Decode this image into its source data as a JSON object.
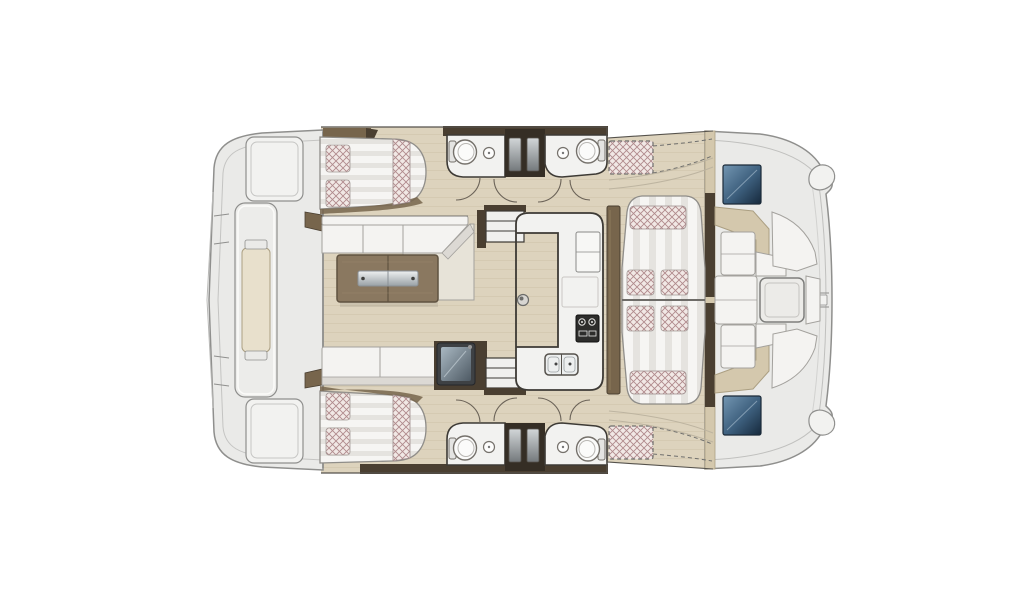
{
  "diagram": {
    "kind": "boat-floor-plan",
    "vessel": "catamaran",
    "view": "top-down-interior-layout",
    "label": "Catamaran interior layout plan, top view: aft platform, two aft double cabins, salon with folding table, galley, four head compartments, forward facing lounge and bow cockpit seating"
  },
  "features": {
    "double_berths": 2,
    "berth_pillows": 4,
    "head_compartments": 4,
    "toilets": 4,
    "wash_basins": 4,
    "interior_staircases": 2,
    "door_swings": 8,
    "salon_sofa_seats": 3,
    "salon_table_leaves": 2,
    "table_handles": 2,
    "dinette_seat_cushions": 4,
    "dinette_bolsters": 2,
    "stove_burners": 2,
    "galley_sink_bowls": 2,
    "deck_hatches_glazed": 2,
    "dashed_sun_pads": 2,
    "bow_cockpit_tables": 1,
    "aft_lockers": 2
  },
  "colors": {
    "bg": "#ffffff",
    "hull": "#eaeae8",
    "hullLight": "#f2f2f0",
    "hullLine": "#8f8f8d",
    "outlineDark": "#55524c",
    "woodFloor": "#ddd3bd",
    "woodGrain": "#c9bda3",
    "woodLight": "#e8e0cc",
    "brownDark": "#4a3f31",
    "brownMid": "#77654c",
    "brownTable": "#8a7860",
    "brownTableDark": "#5f5240",
    "whiteSoft": "#f4f3f1",
    "cushionShade": "#dcd9d4",
    "seatLine": "#a3a19d",
    "stripeA": "#f6f5f3",
    "stripeB": "#e5e3df",
    "hatchBg": "#f1e8e5",
    "hatchLine": "#b08a8c",
    "tan": "#d4c8ad",
    "tanLine": "#ab9f82",
    "counterWhite": "#f2f2f0",
    "counterLine": "#3d3a35",
    "steelA": "#eef0f1",
    "steelB": "#99a1a6",
    "blueA": "#7396b2",
    "blueMid": "#3c5e7c",
    "blueB": "#16293c",
    "boxDark": "#3e4144",
    "screenA": "#a9b8c2",
    "screenB": "#4e5a64",
    "panelA": "#d2d6d8",
    "panelB": "#74797c",
    "arcLine": "#6b6358",
    "dashLine": "#6f6f6d"
  }
}
